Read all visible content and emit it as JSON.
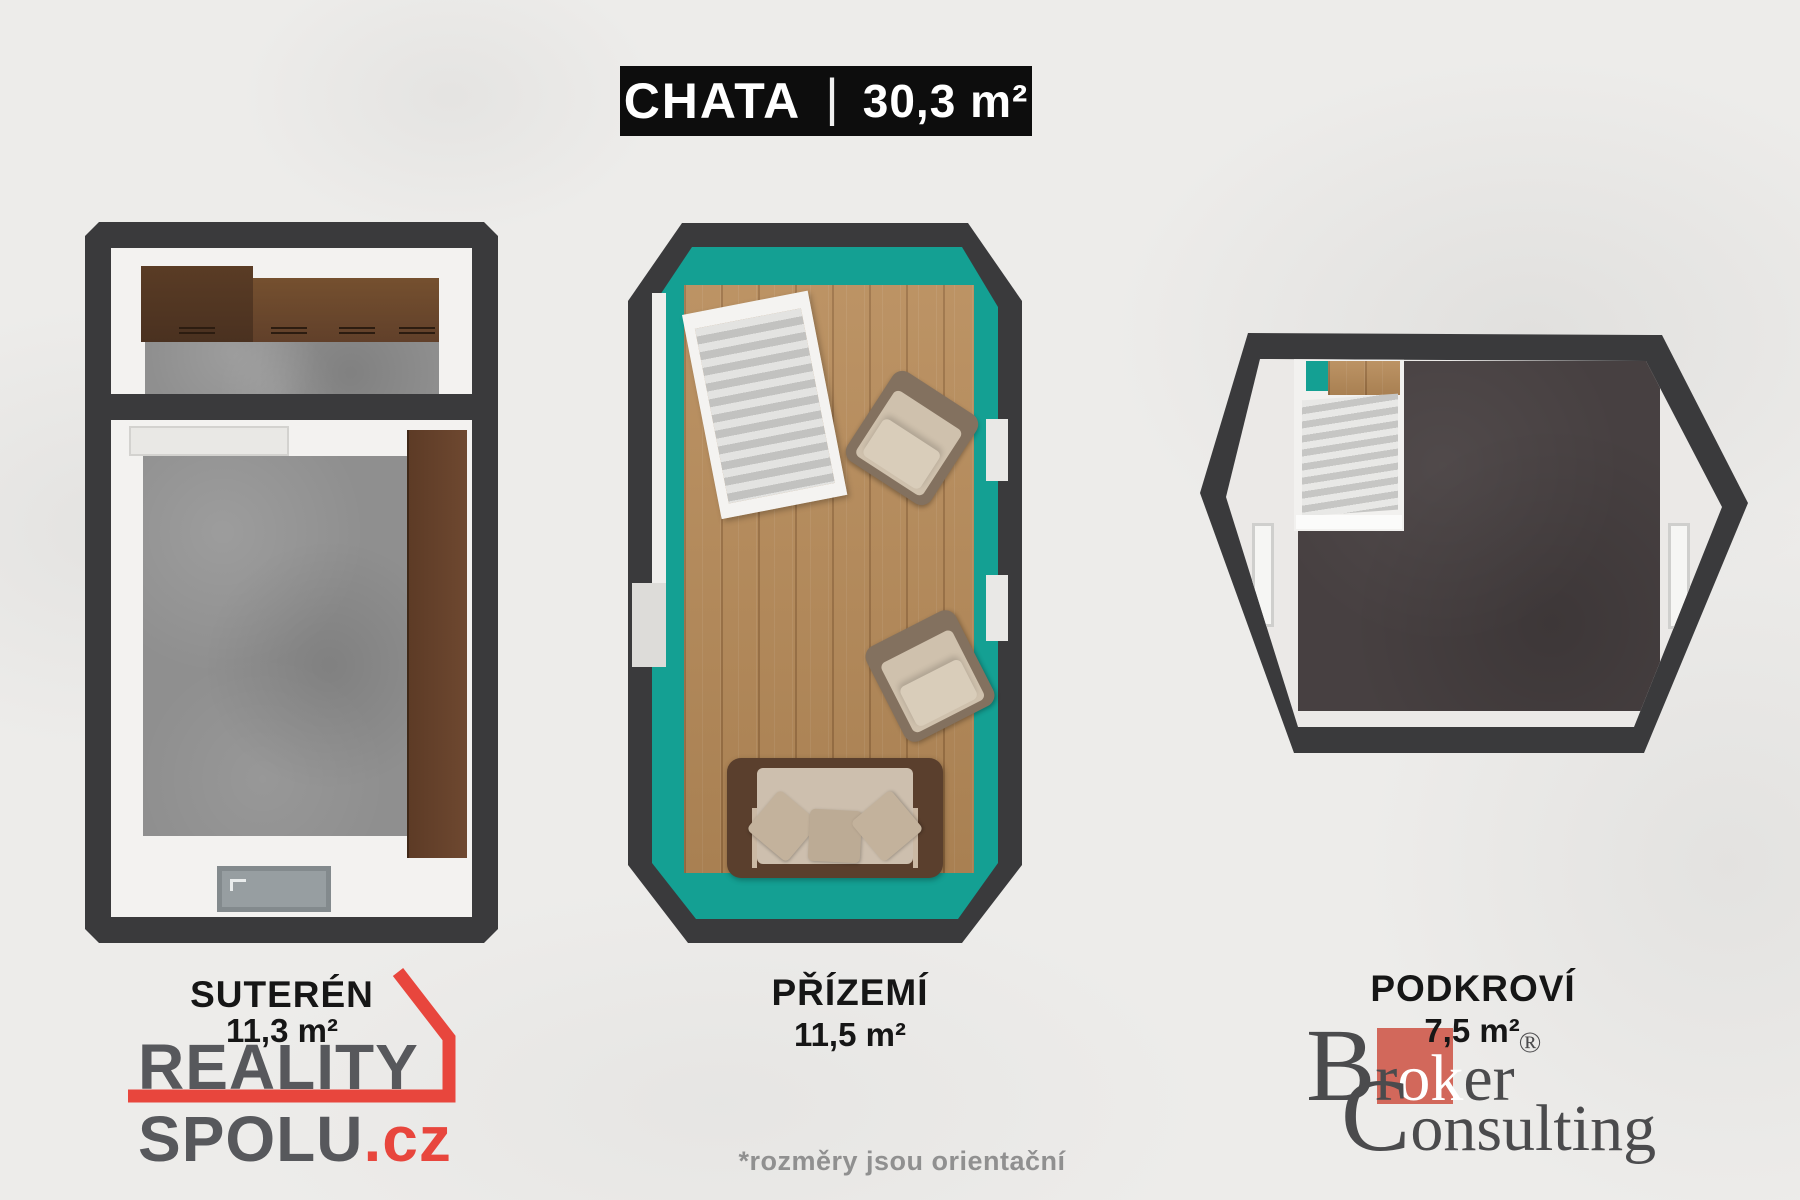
{
  "banner": {
    "title": "CHATA",
    "separator": "|",
    "area": "30,3 m²"
  },
  "plans": [
    {
      "label": "SUTERÉN",
      "area": "11,3 m²"
    },
    {
      "label": "PŘÍZEMÍ",
      "area": "11,5 m²"
    },
    {
      "label": "PODKROVÍ",
      "area": "7,5 m²"
    }
  ],
  "footnote": "*rozměry jsou orientační",
  "logos": {
    "reality_spolu": {
      "word1": "REALITY",
      "word2": "SPOLU",
      "suffix": ".cz"
    },
    "broker_consulting": {
      "cap1": "B",
      "mid1": "r",
      "highlight": "ok",
      "tail1": "er",
      "registered": "®",
      "cap2": "C",
      "tail2": "onsulting"
    }
  },
  "colors": {
    "teal": "#14a093",
    "wall-dark": "#3a3a3c",
    "wood": "#b78b59",
    "concrete": "#8f8f8f",
    "attic-floor": "#474041",
    "logo-red": "#e8463d",
    "broker-red": "#d2685b",
    "logo-gray": "#57585c",
    "banner-bg": "#0d0d0d",
    "background": "#edecea",
    "label-ink": "#161616"
  }
}
